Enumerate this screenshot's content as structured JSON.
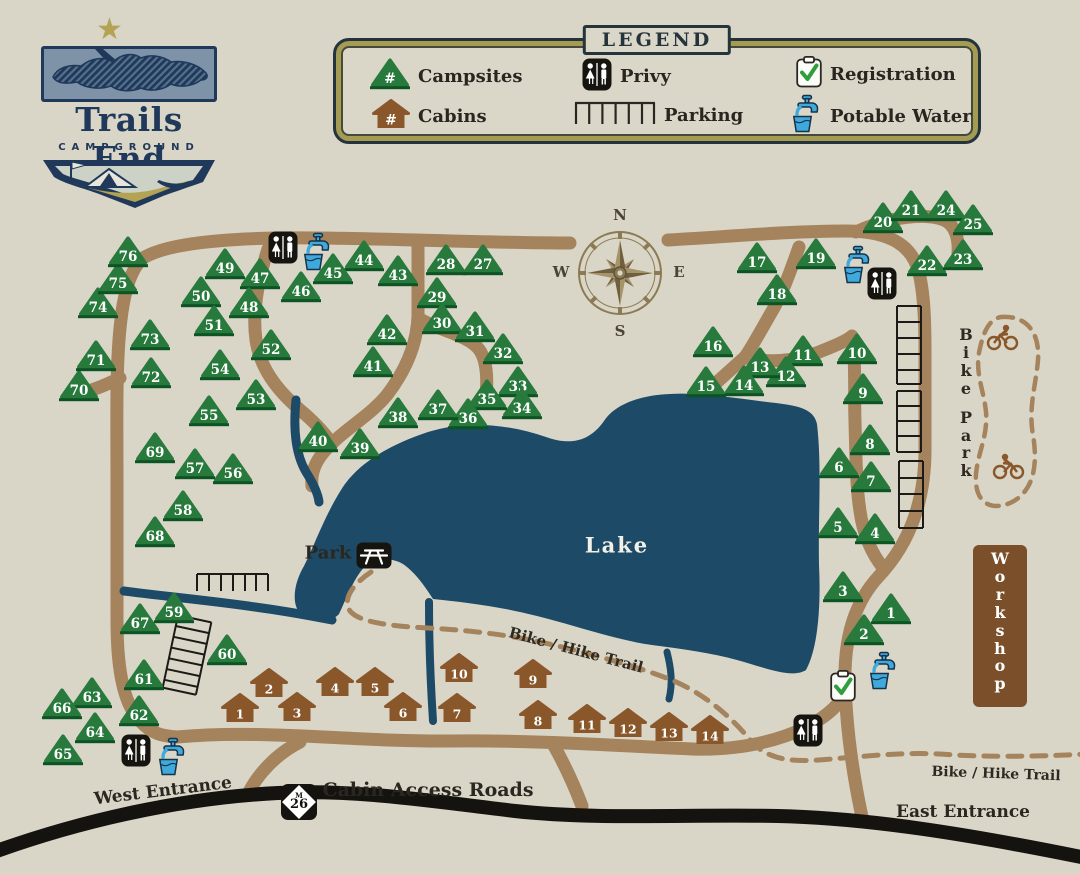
{
  "logo": {
    "title": "Trails End",
    "subtitle": "CAMPGROUND"
  },
  "legend": {
    "title": "LEGEND",
    "number_symbol": "#",
    "campsites_label": "Campsites",
    "cabins_label": "Cabins",
    "privy_label": "Privy",
    "parking_label": "Parking",
    "registration_label": "Registration",
    "potable_water_label": "Potable Water"
  },
  "labels": {
    "lake": "Lake",
    "park": "Park",
    "bike_park": "Bike Park",
    "workshop": "Workshop",
    "west_entrance": "West Entrance",
    "east_entrance": "East Entrance",
    "cabin_access_roads": "Cabin Access Roads",
    "bike_hike_trail_mid": "Bike / Hike Trail",
    "bike_hike_trail_right": "Bike / Hike Trail",
    "m26_letter": "M",
    "m26_number": "26"
  },
  "compass": {
    "north": "N",
    "east": "E",
    "south": "S",
    "west": "W"
  },
  "colors": {
    "background": "#d9d6c8",
    "road": "#a5835c",
    "highway": "#14130f",
    "lake": "#1d4a66",
    "tree": "#27793c",
    "tree_dark": "#0d5424",
    "cabin": "#8a572b",
    "water": "#3fa9dc",
    "workshop": "#7b4f2a",
    "navy": "#20395a",
    "gold": "#b3a353"
  },
  "campsites": [
    {
      "n": "1",
      "x": 891,
      "y": 607
    },
    {
      "n": "2",
      "x": 864,
      "y": 628
    },
    {
      "n": "3",
      "x": 843,
      "y": 585
    },
    {
      "n": "4",
      "x": 875,
      "y": 527
    },
    {
      "n": "5",
      "x": 838,
      "y": 521
    },
    {
      "n": "6",
      "x": 839,
      "y": 461
    },
    {
      "n": "7",
      "x": 871,
      "y": 475
    },
    {
      "n": "8",
      "x": 870,
      "y": 438
    },
    {
      "n": "9",
      "x": 863,
      "y": 387
    },
    {
      "n": "10",
      "x": 857,
      "y": 347
    },
    {
      "n": "11",
      "x": 803,
      "y": 349
    },
    {
      "n": "12",
      "x": 786,
      "y": 370
    },
    {
      "n": "13",
      "x": 760,
      "y": 361
    },
    {
      "n": "14",
      "x": 744,
      "y": 379
    },
    {
      "n": "15",
      "x": 706,
      "y": 380
    },
    {
      "n": "16",
      "x": 713,
      "y": 340
    },
    {
      "n": "17",
      "x": 757,
      "y": 256
    },
    {
      "n": "18",
      "x": 777,
      "y": 288
    },
    {
      "n": "19",
      "x": 816,
      "y": 252
    },
    {
      "n": "20",
      "x": 883,
      "y": 216
    },
    {
      "n": "21",
      "x": 911,
      "y": 204
    },
    {
      "n": "22",
      "x": 927,
      "y": 259
    },
    {
      "n": "23",
      "x": 963,
      "y": 253
    },
    {
      "n": "24",
      "x": 946,
      "y": 204
    },
    {
      "n": "25",
      "x": 973,
      "y": 218
    },
    {
      "n": "27",
      "x": 483,
      "y": 258
    },
    {
      "n": "28",
      "x": 446,
      "y": 258
    },
    {
      "n": "29",
      "x": 437,
      "y": 291
    },
    {
      "n": "30",
      "x": 442,
      "y": 317
    },
    {
      "n": "31",
      "x": 475,
      "y": 325
    },
    {
      "n": "32",
      "x": 503,
      "y": 347
    },
    {
      "n": "33",
      "x": 518,
      "y": 380
    },
    {
      "n": "34",
      "x": 522,
      "y": 402
    },
    {
      "n": "35",
      "x": 487,
      "y": 393
    },
    {
      "n": "36",
      "x": 468,
      "y": 412
    },
    {
      "n": "37",
      "x": 438,
      "y": 403
    },
    {
      "n": "38",
      "x": 398,
      "y": 411
    },
    {
      "n": "39",
      "x": 360,
      "y": 442
    },
    {
      "n": "40",
      "x": 318,
      "y": 435
    },
    {
      "n": "41",
      "x": 373,
      "y": 360
    },
    {
      "n": "42",
      "x": 387,
      "y": 328
    },
    {
      "n": "43",
      "x": 398,
      "y": 269
    },
    {
      "n": "44",
      "x": 364,
      "y": 254
    },
    {
      "n": "45",
      "x": 333,
      "y": 267
    },
    {
      "n": "46",
      "x": 301,
      "y": 285
    },
    {
      "n": "47",
      "x": 260,
      "y": 272
    },
    {
      "n": "48",
      "x": 249,
      "y": 301
    },
    {
      "n": "49",
      "x": 225,
      "y": 262
    },
    {
      "n": "50",
      "x": 201,
      "y": 290
    },
    {
      "n": "51",
      "x": 214,
      "y": 319
    },
    {
      "n": "52",
      "x": 271,
      "y": 343
    },
    {
      "n": "53",
      "x": 256,
      "y": 393
    },
    {
      "n": "54",
      "x": 220,
      "y": 363
    },
    {
      "n": "55",
      "x": 209,
      "y": 409
    },
    {
      "n": "56",
      "x": 233,
      "y": 467
    },
    {
      "n": "57",
      "x": 195,
      "y": 462
    },
    {
      "n": "58",
      "x": 183,
      "y": 504
    },
    {
      "n": "59",
      "x": 174,
      "y": 606
    },
    {
      "n": "60",
      "x": 227,
      "y": 648
    },
    {
      "n": "61",
      "x": 144,
      "y": 673
    },
    {
      "n": "62",
      "x": 139,
      "y": 709
    },
    {
      "n": "63",
      "x": 92,
      "y": 691
    },
    {
      "n": "64",
      "x": 95,
      "y": 726
    },
    {
      "n": "65",
      "x": 63,
      "y": 748
    },
    {
      "n": "66",
      "x": 62,
      "y": 702
    },
    {
      "n": "67",
      "x": 140,
      "y": 617
    },
    {
      "n": "68",
      "x": 155,
      "y": 530
    },
    {
      "n": "69",
      "x": 155,
      "y": 446
    },
    {
      "n": "70",
      "x": 79,
      "y": 384
    },
    {
      "n": "71",
      "x": 96,
      "y": 354
    },
    {
      "n": "72",
      "x": 151,
      "y": 371
    },
    {
      "n": "73",
      "x": 150,
      "y": 333
    },
    {
      "n": "74",
      "x": 98,
      "y": 301
    },
    {
      "n": "75",
      "x": 118,
      "y": 277
    },
    {
      "n": "76",
      "x": 128,
      "y": 250
    }
  ],
  "cabins": [
    {
      "n": "1",
      "x": 240,
      "y": 707
    },
    {
      "n": "2",
      "x": 269,
      "y": 682
    },
    {
      "n": "3",
      "x": 297,
      "y": 706
    },
    {
      "n": "4",
      "x": 335,
      "y": 681
    },
    {
      "n": "5",
      "x": 375,
      "y": 681
    },
    {
      "n": "6",
      "x": 403,
      "y": 706
    },
    {
      "n": "7",
      "x": 457,
      "y": 707
    },
    {
      "n": "8",
      "x": 538,
      "y": 714
    },
    {
      "n": "9",
      "x": 533,
      "y": 673
    },
    {
      "n": "10",
      "x": 459,
      "y": 667
    },
    {
      "n": "11",
      "x": 587,
      "y": 718
    },
    {
      "n": "12",
      "x": 628,
      "y": 722
    },
    {
      "n": "13",
      "x": 669,
      "y": 726
    },
    {
      "n": "14",
      "x": 710,
      "y": 729
    }
  ],
  "amenities": {
    "privy": [
      {
        "x": 283,
        "y": 247
      },
      {
        "x": 882,
        "y": 283
      },
      {
        "x": 136,
        "y": 750
      },
      {
        "x": 808,
        "y": 730
      }
    ],
    "water": [
      {
        "x": 318,
        "y": 252
      },
      {
        "x": 858,
        "y": 265
      },
      {
        "x": 173,
        "y": 757
      },
      {
        "x": 884,
        "y": 671
      }
    ],
    "registration": [
      {
        "x": 843,
        "y": 686
      }
    ],
    "picnic": [
      {
        "x": 374,
        "y": 555
      }
    ]
  }
}
